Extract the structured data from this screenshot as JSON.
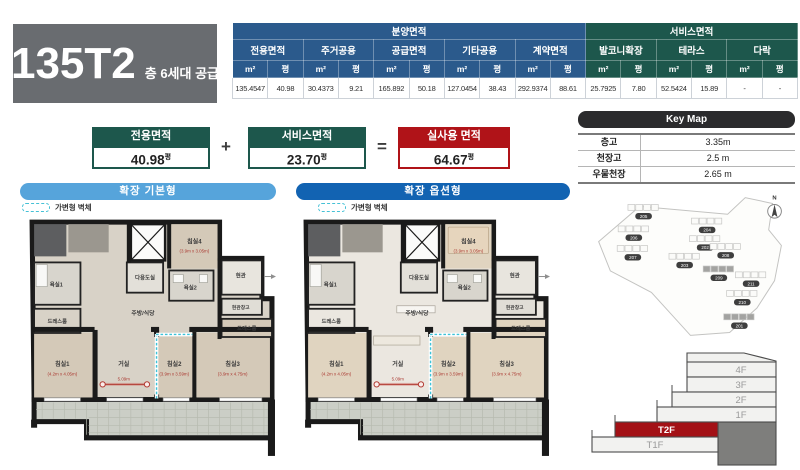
{
  "title": {
    "code": "135T2",
    "supply": "층 6세대 공급"
  },
  "area_table": {
    "groups": [
      "분양면적",
      "서비스면적"
    ],
    "unit_m2": "m²",
    "unit_py": "평",
    "columns": [
      {
        "label": "전용면적",
        "m2": "135.4547",
        "py": "40.98"
      },
      {
        "label": "주거공용",
        "m2": "30.4373",
        "py": "9.21"
      },
      {
        "label": "공급면적",
        "m2": "165.892",
        "py": "50.18"
      },
      {
        "label": "기타공용",
        "m2": "127.0454",
        "py": "38.43"
      },
      {
        "label": "계약면적",
        "m2": "292.9374",
        "py": "88.61"
      },
      {
        "label": "발코니확장",
        "m2": "25.7925",
        "py": "7.80"
      },
      {
        "label": "테라스",
        "m2": "52.5424",
        "py": "15.89"
      },
      {
        "label": "다락",
        "m2": "-",
        "py": "-"
      }
    ]
  },
  "summary": {
    "plus": "+",
    "equals": "=",
    "exclusive": {
      "label": "전용면적",
      "value": "40.98",
      "unit": "평"
    },
    "service": {
      "label": "서비스면적",
      "value": "23.70",
      "unit": "평"
    },
    "actual": {
      "label": "실사용 면적",
      "value": "64.67",
      "unit": "평"
    }
  },
  "keymap": {
    "title": "Key Map",
    "rows": [
      {
        "label": "층고",
        "value": "3.35m"
      },
      {
        "label": "천장고",
        "value": "2.5 m"
      },
      {
        "label": "우물천장",
        "value": "2.65 m"
      }
    ]
  },
  "plans": [
    {
      "title": "확장 기본형",
      "legend": "가변형 벽체",
      "rooms": [
        {
          "name": "침실4",
          "dim": "(3.9m x 3.05m)"
        },
        {
          "name": "욕실1"
        },
        {
          "name": "다용도실"
        },
        {
          "name": "욕실2"
        },
        {
          "name": "현관"
        },
        {
          "name": "현관창고"
        },
        {
          "name": "드레스룸"
        },
        {
          "name": "드레스룸"
        },
        {
          "name": "주방/식당"
        },
        {
          "name": "침실1",
          "dim": "(4.2m x 4.05m)"
        },
        {
          "name": "거실",
          "dim": "5.09m"
        },
        {
          "name": "침실2",
          "dim": "(3.9m x 3.59m)"
        },
        {
          "name": "침실3",
          "dim": "(3.9m x 4.75m)"
        }
      ]
    },
    {
      "title": "확장 옵션형",
      "legend": "가변형 벽체",
      "rooms": [
        {
          "name": "침실4",
          "dim": "(3.9m x 3.05m)"
        },
        {
          "name": "욕실1"
        },
        {
          "name": "다용도실"
        },
        {
          "name": "욕실2"
        },
        {
          "name": "현관"
        },
        {
          "name": "현관창고"
        },
        {
          "name": "드레스룸"
        },
        {
          "name": "드레스룸"
        },
        {
          "name": "주방/식당"
        },
        {
          "name": "침실1",
          "dim": "(4.2m x 4.05m)"
        },
        {
          "name": "거실",
          "dim": "5.09m"
        },
        {
          "name": "침실2",
          "dim": "(3.9m x 3.59m)"
        },
        {
          "name": "침실3",
          "dim": "(3.9m x 4.75m)"
        }
      ]
    }
  ],
  "site_map": {
    "compass": "N",
    "buildings": [
      "205",
      "206",
      "207",
      "203",
      "204",
      "202",
      "208",
      "209",
      "211",
      "210",
      "201"
    ]
  },
  "floor_stack": {
    "floors": [
      "4F",
      "3F",
      "2F",
      "1F",
      "T2F",
      "T1F"
    ],
    "highlighted": "T2F"
  }
}
